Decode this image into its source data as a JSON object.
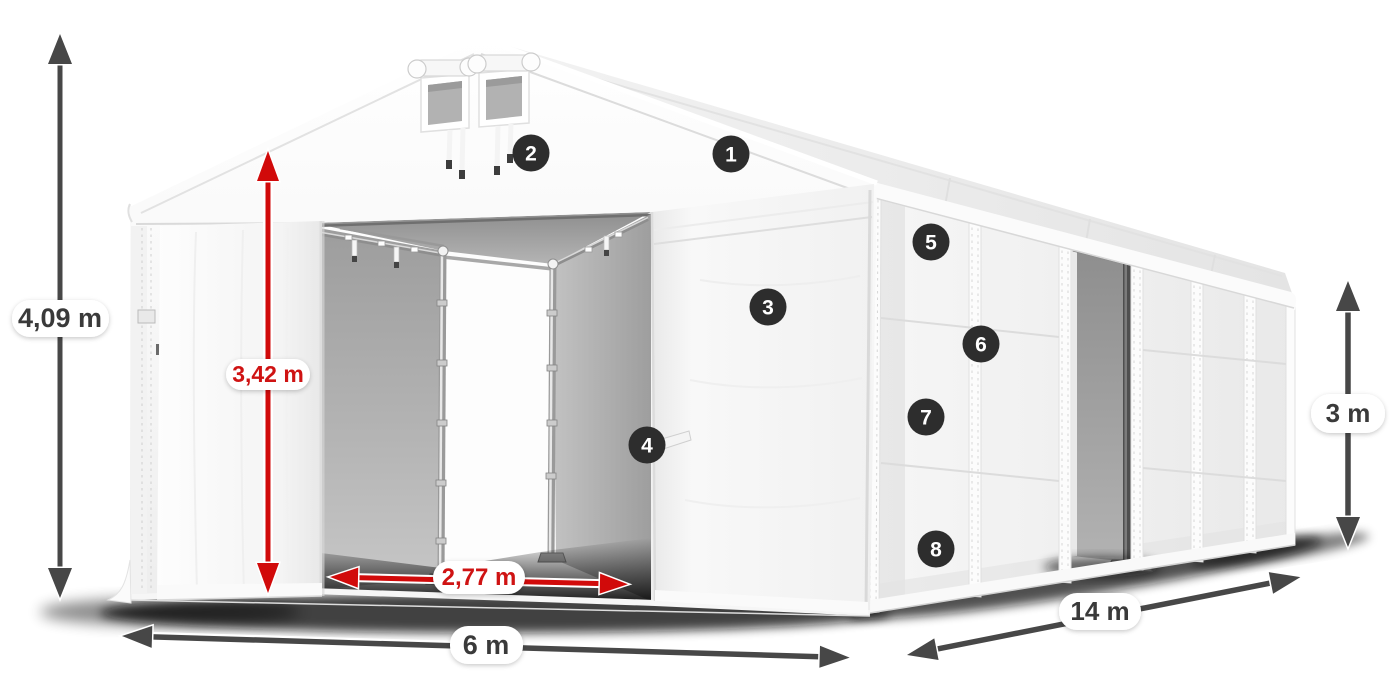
{
  "illustration_title": "Storage tent with dimension callouts",
  "dimensions": {
    "total_height": "4,09 m",
    "entrance_height": "3,42 m",
    "entrance_width": "2,77 m",
    "front_width": "6 m",
    "side_length": "14 m",
    "side_height": "3 m"
  },
  "badges": [
    "1",
    "2",
    "3",
    "4",
    "5",
    "6",
    "7",
    "8"
  ],
  "colors": {
    "arrow_dark": "#474747",
    "arrow_red": "#d10a0a",
    "badge_background": "#2d2d2d",
    "label_text_dark": "#3a3a3a",
    "label_text_red": "#cf1313",
    "fabric_white": "#f4f4f4",
    "interior_gray": "#a8a8a8"
  }
}
